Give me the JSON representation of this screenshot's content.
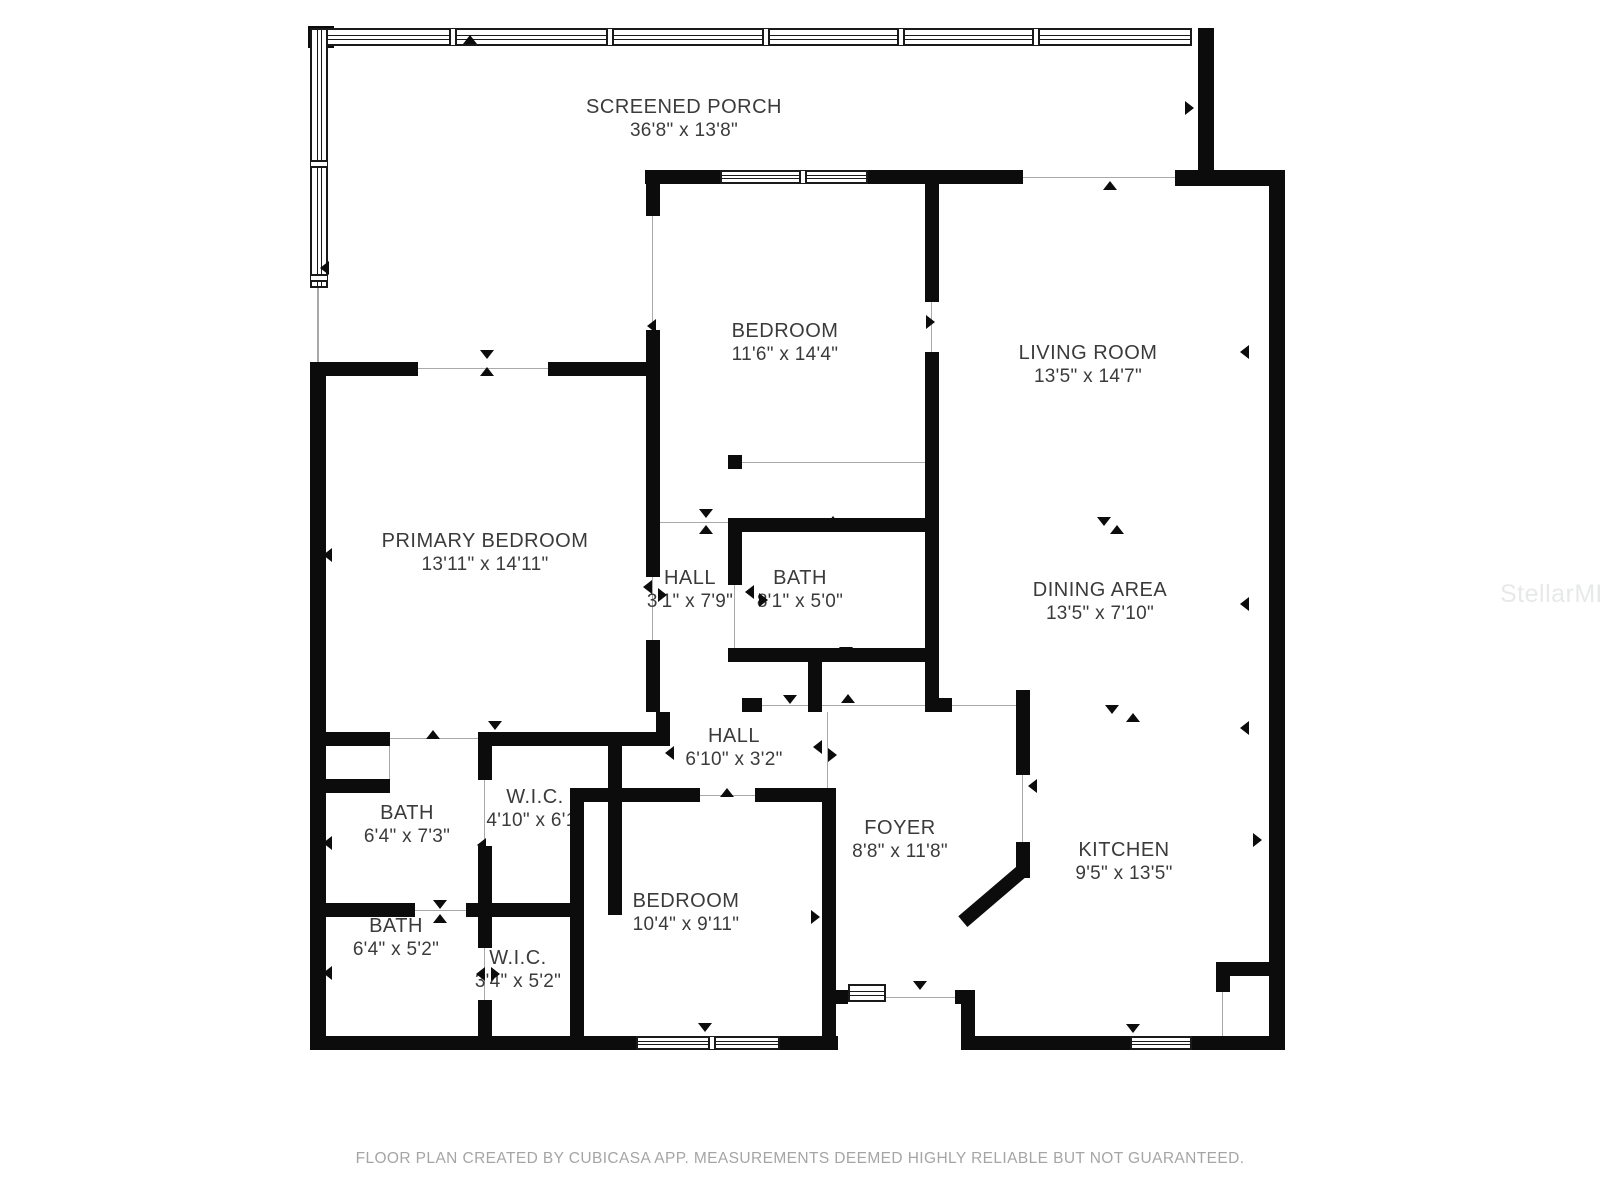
{
  "page": {
    "footer": "FLOOR PLAN CREATED BY CUBICASA APP. MEASUREMENTS DEEMED HIGHLY RELIABLE BUT NOT GUARANTEED.",
    "watermark": "StellarMLS"
  },
  "colors": {
    "wall": "#0c0c0c",
    "thin_line": "#a9a9a9",
    "label_text": "#3b3b3b",
    "footer_text": "#a5a5a5",
    "watermark_text": "#e7e9e9",
    "background": "#ffffff"
  },
  "rooms": [
    {
      "id": "screened-porch",
      "name": "SCREENED PORCH",
      "dim": "36'8\" x 13'8\"",
      "x": 684,
      "y": 119
    },
    {
      "id": "bedroom-1",
      "name": "BEDROOM",
      "dim": "11'6\" x 14'4\"",
      "x": 785,
      "y": 343
    },
    {
      "id": "living-room",
      "name": "LIVING ROOM",
      "dim": "13'5\" x 14'7\"",
      "x": 1088,
      "y": 365
    },
    {
      "id": "primary-bedroom",
      "name": "PRIMARY BEDROOM",
      "dim": "13'11\" x 14'11\"",
      "x": 485,
      "y": 553
    },
    {
      "id": "hall-upper",
      "name": "HALL",
      "dim": "3'1\" x 7'9\"",
      "x": 690,
      "y": 590
    },
    {
      "id": "bath-main",
      "name": "BATH",
      "dim": "8'1\" x 5'0\"",
      "x": 800,
      "y": 590
    },
    {
      "id": "dining-area",
      "name": "DINING AREA",
      "dim": "13'5\" x 7'10\"",
      "x": 1100,
      "y": 602
    },
    {
      "id": "hall-lower",
      "name": "HALL",
      "dim": "6'10\" x 3'2\"",
      "x": 734,
      "y": 748
    },
    {
      "id": "bath-upper",
      "name": "BATH",
      "dim": "6'4\" x 7'3\"",
      "x": 407,
      "y": 825
    },
    {
      "id": "wic-upper",
      "name": "W.I.C.",
      "dim": "4'10\" x 6'1\"",
      "x": 535,
      "y": 809
    },
    {
      "id": "foyer",
      "name": "FOYER",
      "dim": "8'8\" x 11'8\"",
      "x": 900,
      "y": 840
    },
    {
      "id": "kitchen",
      "name": "KITCHEN",
      "dim": "9'5\" x 13'5\"",
      "x": 1124,
      "y": 862
    },
    {
      "id": "bath-lower",
      "name": "BATH",
      "dim": "6'4\" x 5'2\"",
      "x": 396,
      "y": 938
    },
    {
      "id": "wic-lower",
      "name": "W.I.C.",
      "dim": "3'4\" x 5'2\"",
      "x": 518,
      "y": 970
    },
    {
      "id": "bedroom-2",
      "name": "BEDROOM",
      "dim": "10'4\" x 9'11\"",
      "x": 686,
      "y": 913
    }
  ],
  "plan": {
    "walls": [
      [
        308,
        26,
        26,
        22
      ],
      [
        1198,
        28,
        16,
        156
      ],
      [
        1175,
        170,
        110,
        16
      ],
      [
        1269,
        170,
        16,
        880
      ],
      [
        310,
        362,
        16,
        688
      ],
      [
        310,
        1036,
        330,
        14
      ],
      [
        778,
        1036,
        60,
        14
      ],
      [
        961,
        1036,
        171,
        14
      ],
      [
        1190,
        1036,
        95,
        14
      ],
      [
        310,
        362,
        108,
        14
      ],
      [
        548,
        362,
        112,
        14
      ],
      [
        645,
        170,
        77,
        14
      ],
      [
        866,
        170,
        157,
        14
      ],
      [
        646,
        170,
        14,
        46
      ],
      [
        646,
        330,
        14,
        46
      ],
      [
        646,
        362,
        14,
        215
      ],
      [
        646,
        640,
        14,
        72
      ],
      [
        925,
        170,
        14,
        132
      ],
      [
        925,
        352,
        14,
        360
      ],
      [
        728,
        455,
        14,
        14
      ],
      [
        728,
        518,
        211,
        14
      ],
      [
        728,
        532,
        14,
        53
      ],
      [
        728,
        648,
        211,
        14
      ],
      [
        808,
        662,
        14,
        50
      ],
      [
        742,
        698,
        20,
        14
      ],
      [
        925,
        698,
        27,
        14
      ],
      [
        656,
        712,
        14,
        34
      ],
      [
        492,
        732,
        178,
        14
      ],
      [
        478,
        732,
        14,
        48
      ],
      [
        478,
        846,
        14,
        71
      ],
      [
        608,
        746,
        14,
        169
      ],
      [
        310,
        732,
        80,
        14
      ],
      [
        310,
        779,
        80,
        14
      ],
      [
        310,
        903,
        105,
        14
      ],
      [
        466,
        903,
        104,
        14
      ],
      [
        478,
        917,
        14,
        31
      ],
      [
        478,
        1000,
        14,
        36
      ],
      [
        570,
        788,
        14,
        248
      ],
      [
        570,
        788,
        130,
        14
      ],
      [
        755,
        788,
        67,
        14
      ],
      [
        822,
        788,
        14,
        248
      ],
      [
        822,
        990,
        26,
        14
      ],
      [
        955,
        990,
        20,
        14
      ],
      [
        961,
        1004,
        14,
        32
      ],
      [
        1016,
        690,
        14,
        85
      ],
      [
        1016,
        842,
        14,
        36
      ],
      [
        1216,
        962,
        68,
        14
      ],
      [
        1216,
        976,
        14,
        16
      ]
    ],
    "diagonal": {
      "x": 953,
      "y": 888,
      "w": 82,
      "h": 14,
      "angle": -40.5
    },
    "thin_lines": [
      [
        317,
        288,
        2,
        74
      ],
      [
        418,
        368,
        130,
        1
      ],
      [
        652,
        216,
        1,
        114
      ],
      [
        1023,
        177,
        152,
        1
      ],
      [
        931,
        302,
        1,
        50
      ],
      [
        652,
        577,
        1,
        63
      ],
      [
        742,
        462,
        183,
        1
      ],
      [
        660,
        522,
        68,
        1
      ],
      [
        734,
        585,
        1,
        63
      ],
      [
        762,
        705,
        163,
        1
      ],
      [
        390,
        738,
        92,
        1
      ],
      [
        484,
        780,
        1,
        66
      ],
      [
        415,
        910,
        51,
        1
      ],
      [
        484,
        948,
        1,
        52
      ],
      [
        1022,
        775,
        1,
        67
      ],
      [
        1222,
        992,
        1,
        44
      ],
      [
        886,
        997,
        69,
        1
      ],
      [
        827,
        712,
        1,
        76
      ],
      [
        952,
        705,
        64,
        1
      ],
      [
        389,
        746,
        1,
        33
      ],
      [
        700,
        795,
        55,
        1
      ],
      [
        818,
        917,
        1,
        1
      ]
    ],
    "windows": [
      {
        "x": 310,
        "y": 28,
        "w": 882,
        "h": 18,
        "dividers": [
          447,
          604,
          760,
          895,
          1030
        ]
      },
      {
        "x": 310,
        "y": 28,
        "w": 18,
        "h": 260,
        "dividers": [
          158,
          272
        ]
      },
      {
        "x": 720,
        "y": 170,
        "w": 148,
        "h": 14,
        "dividers": [
          797
        ]
      },
      {
        "x": 636,
        "y": 1036,
        "w": 144,
        "h": 14,
        "dividers": [
          706
        ]
      },
      {
        "x": 1130,
        "y": 1036,
        "w": 62,
        "h": 14,
        "dividers": []
      },
      {
        "x": 848,
        "y": 984,
        "w": 38,
        "h": 18,
        "dividers": []
      }
    ],
    "arrows": [
      {
        "x": 470,
        "y": 42,
        "d": "up"
      },
      {
        "x": 327,
        "y": 268,
        "d": "left"
      },
      {
        "x": 1192,
        "y": 108,
        "d": "right"
      },
      {
        "x": 487,
        "y": 357,
        "d": "down"
      },
      {
        "x": 487,
        "y": 374,
        "d": "up"
      },
      {
        "x": 654,
        "y": 326,
        "d": "left"
      },
      {
        "x": 933,
        "y": 322,
        "d": "right"
      },
      {
        "x": 1110,
        "y": 188,
        "d": "up"
      },
      {
        "x": 1247,
        "y": 352,
        "d": "left"
      },
      {
        "x": 1247,
        "y": 604,
        "d": "left"
      },
      {
        "x": 1247,
        "y": 728,
        "d": "left"
      },
      {
        "x": 1260,
        "y": 840,
        "d": "right"
      },
      {
        "x": 1104,
        "y": 524,
        "d": "down"
      },
      {
        "x": 1117,
        "y": 532,
        "d": "up"
      },
      {
        "x": 1112,
        "y": 712,
        "d": "down"
      },
      {
        "x": 1133,
        "y": 720,
        "d": "up"
      },
      {
        "x": 650,
        "y": 587,
        "d": "left"
      },
      {
        "x": 665,
        "y": 595,
        "d": "right"
      },
      {
        "x": 706,
        "y": 516,
        "d": "down"
      },
      {
        "x": 706,
        "y": 532,
        "d": "up"
      },
      {
        "x": 752,
        "y": 592,
        "d": "left"
      },
      {
        "x": 766,
        "y": 600,
        "d": "right"
      },
      {
        "x": 833,
        "y": 523,
        "d": "up"
      },
      {
        "x": 846,
        "y": 654,
        "d": "down"
      },
      {
        "x": 790,
        "y": 702,
        "d": "down"
      },
      {
        "x": 848,
        "y": 701,
        "d": "up"
      },
      {
        "x": 330,
        "y": 555,
        "d": "left"
      },
      {
        "x": 330,
        "y": 843,
        "d": "left"
      },
      {
        "x": 330,
        "y": 973,
        "d": "left"
      },
      {
        "x": 433,
        "y": 737,
        "d": "up"
      },
      {
        "x": 495,
        "y": 728,
        "d": "down"
      },
      {
        "x": 530,
        "y": 743,
        "d": "up"
      },
      {
        "x": 484,
        "y": 845,
        "d": "left"
      },
      {
        "x": 440,
        "y": 907,
        "d": "down"
      },
      {
        "x": 440,
        "y": 921,
        "d": "up"
      },
      {
        "x": 483,
        "y": 974,
        "d": "left"
      },
      {
        "x": 498,
        "y": 974,
        "d": "right"
      },
      {
        "x": 727,
        "y": 795,
        "d": "up"
      },
      {
        "x": 672,
        "y": 753,
        "d": "left"
      },
      {
        "x": 820,
        "y": 747,
        "d": "left"
      },
      {
        "x": 835,
        "y": 755,
        "d": "right"
      },
      {
        "x": 818,
        "y": 917,
        "d": "right"
      },
      {
        "x": 1035,
        "y": 786,
        "d": "left"
      },
      {
        "x": 920,
        "y": 988,
        "d": "down"
      },
      {
        "x": 1133,
        "y": 1031,
        "d": "down"
      },
      {
        "x": 705,
        "y": 1030,
        "d": "down"
      }
    ]
  }
}
